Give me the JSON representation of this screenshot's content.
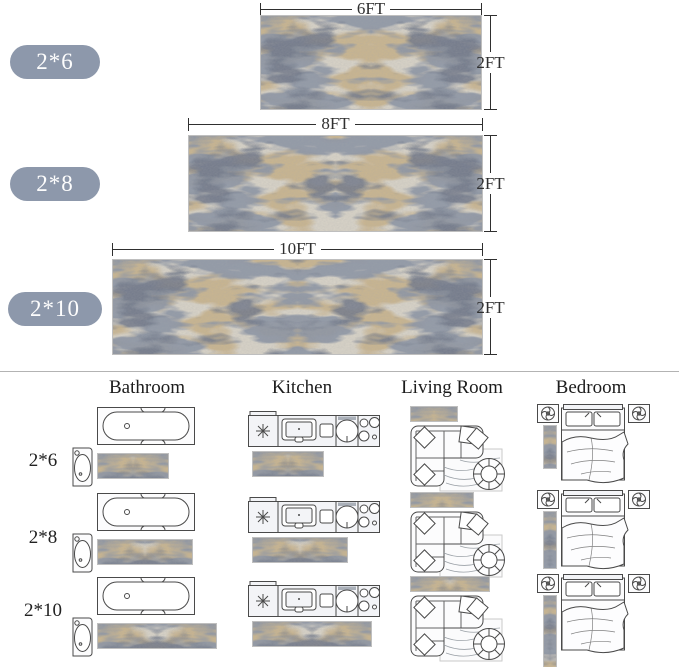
{
  "product_sizes": [
    {
      "badge": "2*6",
      "length_label": "6FT",
      "width_label": "2FT",
      "length_ft": 6
    },
    {
      "badge": "2*8",
      "length_label": "8FT",
      "width_label": "2FT",
      "length_ft": 8
    },
    {
      "badge": "2*10",
      "length_label": "10FT",
      "width_label": "2FT",
      "length_ft": 10
    }
  ],
  "room_guide": {
    "headers": [
      {
        "label": "Bathroom"
      },
      {
        "label": "Kitchen"
      },
      {
        "label": "Living Room"
      },
      {
        "label": "Bedroom"
      }
    ],
    "rows": [
      {
        "label": "2*6",
        "length_ft": 6
      },
      {
        "label": "2*8",
        "length_ft": 8
      },
      {
        "label": "2*10",
        "length_ft": 10
      }
    ],
    "icons": [
      "bathtub-icon",
      "pedestal-sink-icon",
      "kitchen-counter-icon",
      "sectional-sofa-icon",
      "area-rug-icon",
      "round-chair-icon",
      "bed-icon",
      "nightstand-icon",
      "rug-swatch"
    ]
  },
  "colors": {
    "badge_bg": "#8d98ab",
    "badge_text": "#fdfdfd",
    "dimension": "#2f2f2f",
    "divider": "#b3b3b3",
    "icon_stroke": "#4a4a4a",
    "icon_fill": "#f3f4f7",
    "rug_palette": {
      "base": "#d8d3c7",
      "tan": "#c8b28a",
      "blue_gray": "#8b94a4",
      "dark_blue_gray": "#6f7788",
      "border": "#bfbfbf"
    }
  }
}
